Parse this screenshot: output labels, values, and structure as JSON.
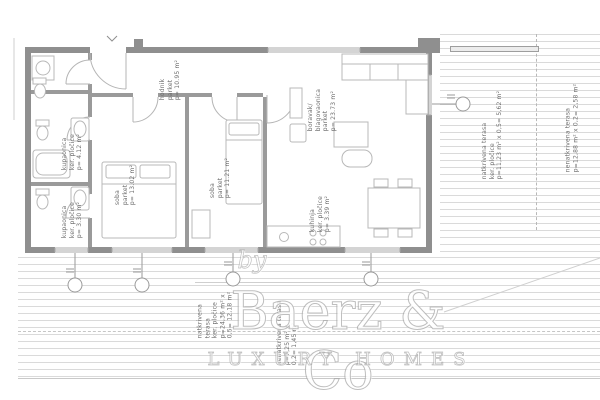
{
  "labels": {
    "hodnik": {
      "lines": [
        "hodnik",
        "parket",
        "p= 10.95 m²"
      ]
    },
    "kupaonica1": {
      "lines": [
        "kupaonica",
        "ker. pločice",
        "p= 4.12 m²"
      ]
    },
    "kupaonica2": {
      "lines": [
        "kupaonica",
        "ker. pločice",
        "p= 3.30 m²"
      ]
    },
    "soba1": {
      "lines": [
        "soba",
        "parket",
        "p= 13.02 m²"
      ]
    },
    "soba2": {
      "lines": [
        "soba",
        "parket",
        "p= 11.21 m²"
      ]
    },
    "boravak": {
      "lines": [
        "boravak/",
        "blagovaonica",
        "parket",
        "p= 23.73 m²"
      ]
    },
    "kuhinja": {
      "lines": [
        "kuhinja",
        "ker. pločice",
        "p= 3.39 m²"
      ]
    },
    "terasa_right_covered": {
      "lines": [
        "natkrivena terasa",
        "ker. pločice",
        "p=11,23 m² x 0,5= 5,62 m²"
      ]
    },
    "terasa_right_open": {
      "lines": [
        "nenatkrivena terasa",
        "p=12,88 m² x 0,2= 2,58 m²"
      ]
    },
    "terasa_bottom_covered": {
      "lines": [
        "natkrivena",
        "terasa",
        "ker. pločice",
        "p=24,36 m² x",
        "0,5= 12,18 m²"
      ]
    },
    "terasa_bottom_open": {
      "lines": [
        "nenatkrivena terasa",
        "p=7,25 m² x",
        "0,2= 1,45 m²"
      ]
    }
  },
  "watermark": {
    "by": "by",
    "brand": "Baerz & Co",
    "tagline": "LUXURY HOMES"
  }
}
